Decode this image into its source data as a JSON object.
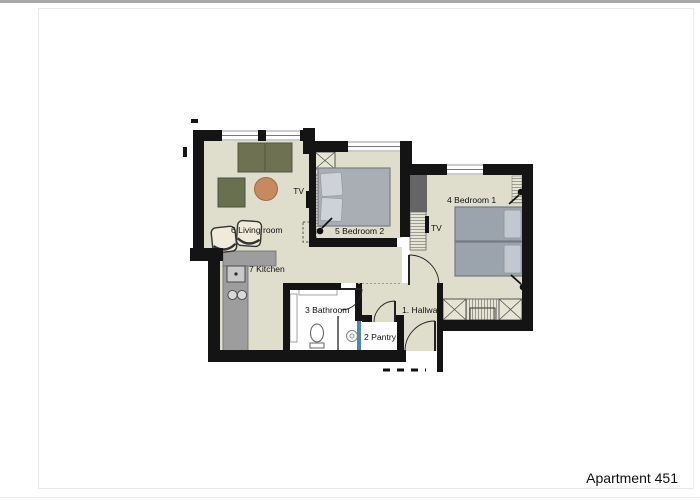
{
  "page": {
    "title": "Apartment 451"
  },
  "floorplan": {
    "rooms": [
      {
        "label": "1. Hallway"
      },
      {
        "label": "2 Pantry"
      },
      {
        "label": "3 Bathroom"
      },
      {
        "label": "4 Bedroom 1"
      },
      {
        "label": "5 Bedroom 2"
      },
      {
        "label": "6 Living room"
      },
      {
        "label": "7 Kitchen"
      }
    ],
    "tv_labels": {
      "living": "TV",
      "bedroom1": "TV"
    },
    "colors": {
      "wall": "#141414",
      "floor": "#dfddcc",
      "room_white": "#ffffff",
      "sofa": "#6e7253",
      "tv_stand": "#687050",
      "coffee_table": "#c78a5f",
      "armchair": "#efead9",
      "bed_bedroom2": "#a9aeb4",
      "pillow_bedroom2": "#ced2d7",
      "bed_bedroom1": "#9ba3ad",
      "pillow_bedroom1": "#c2c8cf",
      "kitchen_counter": "#9d9d9d",
      "dark_unit": "#656565",
      "shower_glass": "#4f86ac"
    }
  }
}
